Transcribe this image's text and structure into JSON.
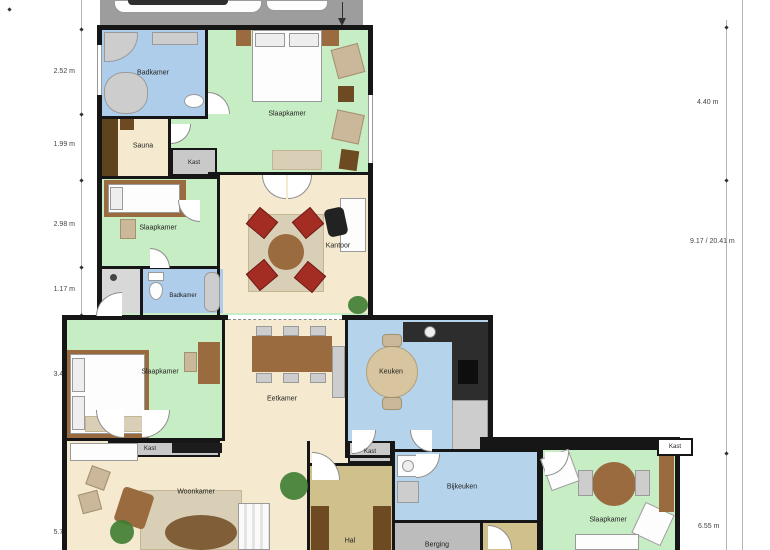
{
  "palette": {
    "wall": "#161616",
    "bedroom": "#c7edc4",
    "bathroom": "#adcdea",
    "kitchen": "#b6d3ec",
    "living": "#f5e9cf",
    "halc": "#cfc08c",
    "closet": "#c9c9c9",
    "storage": "#bcbcbc",
    "garage": "#9d9d9d",
    "saunafloor": "#5f431c",
    "wood": "#9a6b3f",
    "wooddark": "#6e4a22",
    "rug": "#d9cfb6",
    "chairred": "#a32c23",
    "plant": "#3e7d32",
    "shower": "#d8d8d8"
  },
  "rooms": [
    {
      "id": "badkamer-1",
      "label": "Badkamer"
    },
    {
      "id": "slaapkamer-1",
      "label": "Slaapkamer"
    },
    {
      "id": "sauna",
      "label": "Sauna"
    },
    {
      "id": "kast-1",
      "label": "Kast"
    },
    {
      "id": "slaapkamer-2",
      "label": "Slaapkamer"
    },
    {
      "id": "kantoor",
      "label": "Kantoor"
    },
    {
      "id": "badkamer-2",
      "label": "Badkamer"
    },
    {
      "id": "slaapkamer-3",
      "label": "Slaapkamer"
    },
    {
      "id": "kast-2",
      "label": "Kast"
    },
    {
      "id": "eetkamer",
      "label": "Eetkamer"
    },
    {
      "id": "keuken",
      "label": "Keuken"
    },
    {
      "id": "woonkamer",
      "label": "Woonkamer"
    },
    {
      "id": "kast-3",
      "label": "Kast"
    },
    {
      "id": "hal",
      "label": "Hal"
    },
    {
      "id": "bijkeuken",
      "label": "Bijkeuken"
    },
    {
      "id": "berging",
      "label": "Berging"
    },
    {
      "id": "slaapkamer-4",
      "label": "Slaapkamer"
    },
    {
      "id": "kast-4",
      "label": "Kast"
    }
  ],
  "dimensions": {
    "left": [
      {
        "label": "2.52 m"
      },
      {
        "label": "1.99 m"
      },
      {
        "label": "2.98 m"
      },
      {
        "label": "1.17 m"
      },
      {
        "label": "3.41 m"
      },
      {
        "label": "5.74 m"
      }
    ],
    "right": [
      {
        "label": "4.40 m"
      },
      {
        "label": "9.17 / 20.41 m"
      },
      {
        "label": "6.55 m"
      }
    ]
  }
}
